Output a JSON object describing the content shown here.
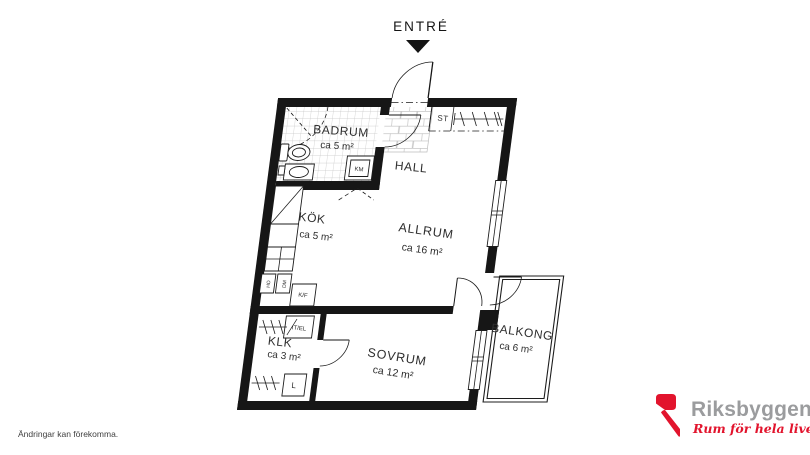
{
  "plan": {
    "entry_label": "ENTRÉ",
    "rooms": {
      "badrum": {
        "name": "BADRUM",
        "area": "ca 5 m²"
      },
      "hall": {
        "name": "HALL"
      },
      "kok": {
        "name": "KÖK",
        "area": "ca 5 m²"
      },
      "allrum": {
        "name": "ALLRUM",
        "area": "ca 16 m²"
      },
      "klk": {
        "name": "KLK",
        "area": "ca 3 m²"
      },
      "sovrum": {
        "name": "SOVRUM",
        "area": "ca 12 m²"
      },
      "balkong": {
        "name": "BALKONG",
        "area": "ca 6 m²"
      }
    },
    "fixtures": {
      "st": "ST",
      "km": "KM",
      "kf": "K/F",
      "itel": "IT/EL",
      "l": "L",
      "ho": "HO",
      "dm": "DM"
    }
  },
  "footer": {
    "disclaimer": "Ändringar kan förekomma."
  },
  "brand": {
    "name": "Riksbyggen",
    "tagline": "Rum för hela livet"
  },
  "colors": {
    "wall": "#161616",
    "accent_red": "#e2142d",
    "brand_gray": "#9b9c9e",
    "label": "#2e2e2e",
    "tile_line": "#c6c6c6"
  }
}
